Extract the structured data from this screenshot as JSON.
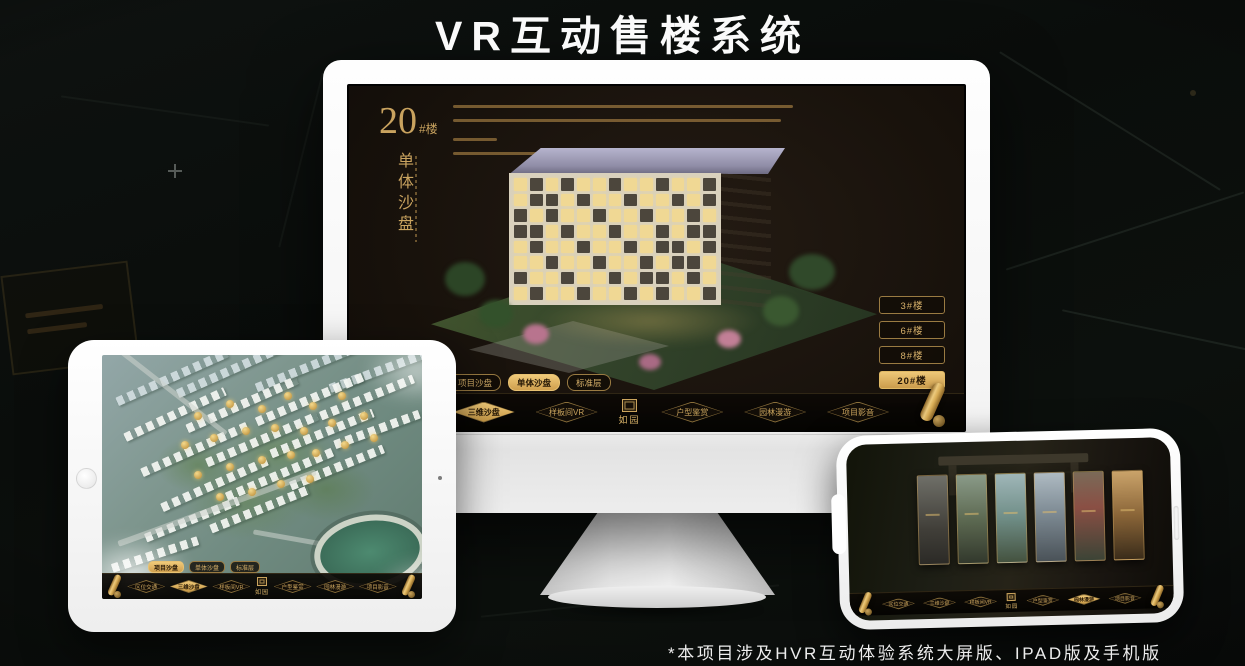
{
  "title": "VR互动售楼系统",
  "footnote": "*本项目涉及HVR互动体验系统大屏版、IPAD版及手机版",
  "brand": {
    "name": "如园"
  },
  "colors": {
    "gold": "#c9a35f",
    "gold_bright": "#eec878",
    "app_bg": "#17110b",
    "page_bg": "#0c0f0d"
  },
  "monitor_app": {
    "block": {
      "num": "20",
      "suffix": "#楼",
      "subtitle": "单体沙盘"
    },
    "floor_buttons": [
      {
        "label": "3#楼",
        "active": false
      },
      {
        "label": "6#楼",
        "active": false
      },
      {
        "label": "8#楼",
        "active": false
      },
      {
        "label": "20#楼",
        "active": true
      }
    ],
    "sub_tabs": [
      {
        "label": "项目沙盘",
        "active": false
      },
      {
        "label": "单体沙盘",
        "active": true
      },
      {
        "label": "标准层",
        "active": false
      }
    ],
    "nav": {
      "left": [
        "区位交通",
        "三维沙盘",
        "样板间VR"
      ],
      "right": [
        "户型鉴赏",
        "园林漫游",
        "项目影音"
      ],
      "active": "三维沙盘"
    }
  },
  "tablet_app": {
    "sub_tabs": [
      {
        "label": "项目沙盘",
        "active": true
      },
      {
        "label": "单体沙盘",
        "active": false
      },
      {
        "label": "标准层",
        "active": false
      }
    ],
    "nav": {
      "left": [
        "区位交通",
        "三维沙盘",
        "样板间VR"
      ],
      "right": [
        "户型鉴赏",
        "园林漫游",
        "项目影音"
      ],
      "active": "三维沙盘"
    }
  },
  "phone_app": {
    "nav": {
      "left": [
        "区位交通",
        "三维沙盘",
        "样板间VR"
      ],
      "right": [
        "户型鉴赏",
        "园林漫游",
        "项目影音"
      ],
      "active": "园林漫游"
    }
  }
}
